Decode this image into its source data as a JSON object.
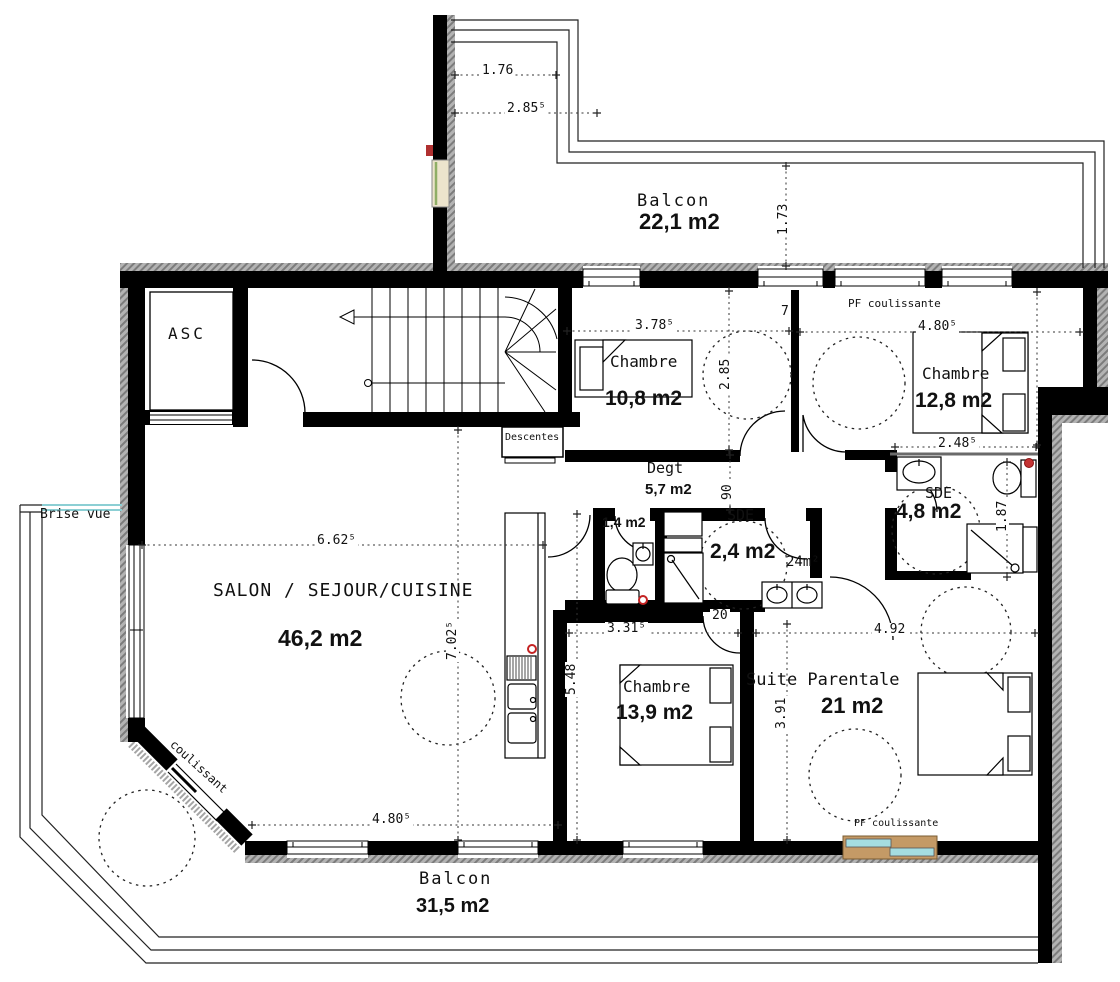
{
  "meta": {
    "title": "Plan d'étage - appartement"
  },
  "colors": {
    "wall": "#000000",
    "hatch": "#a8a8a8",
    "line": "#222222",
    "glass_cyan": "#a5dde0",
    "frame_tan": "#c49a66",
    "glass_green": "#8fae66",
    "accent_red": "#c42222"
  },
  "labels": [
    {
      "name": "asc-room-label",
      "text": "ASC",
      "x": 168,
      "y": 326,
      "cls": "room ls3"
    },
    {
      "name": "balcony-top-label",
      "text": "Balcon",
      "x": 637,
      "y": 193,
      "cls": "room r17 ls2"
    },
    {
      "name": "balcony-top-area",
      "text": "22,1 m2",
      "x": 639,
      "y": 211,
      "cls": "area a22"
    },
    {
      "name": "pf-coulissante-top-label",
      "text": "PF coulissante",
      "x": 848,
      "y": 298,
      "cls": "tiny"
    },
    {
      "name": "bedroom1-label",
      "text": "Chambre",
      "x": 610,
      "y": 354,
      "cls": "room"
    },
    {
      "name": "bedroom1-area",
      "text": "10,8 m2",
      "x": 605,
      "y": 388,
      "cls": "area a21"
    },
    {
      "name": "bedroom2-label",
      "text": "Chambre",
      "x": 922,
      "y": 366,
      "cls": "room"
    },
    {
      "name": "bedroom2-area",
      "text": "12,8 m2",
      "x": 915,
      "y": 390,
      "cls": "area a21"
    },
    {
      "name": "degagement-label",
      "text": "Degt",
      "x": 647,
      "y": 461,
      "cls": "room r15"
    },
    {
      "name": "degagement-area",
      "text": "5,7 m2",
      "x": 645,
      "y": 482,
      "cls": "area a15"
    },
    {
      "name": "wc-area",
      "text": "1,4 m2",
      "x": 602,
      "y": 515,
      "cls": "area a14"
    },
    {
      "name": "sde1-label",
      "text": "SDE",
      "x": 727,
      "y": 508,
      "cls": "room r15"
    },
    {
      "name": "sde1-area",
      "text": "2,4 m2",
      "x": 710,
      "y": 541,
      "cls": "area a21"
    },
    {
      "name": "vanity-note",
      "text": "24m²",
      "x": 786,
      "y": 555,
      "cls": "room r14"
    },
    {
      "name": "sde2-label",
      "text": "SDE",
      "x": 925,
      "y": 486,
      "cls": "room r15"
    },
    {
      "name": "sde2-area",
      "text": "4,8 m2",
      "x": 896,
      "y": 501,
      "cls": "area a21"
    },
    {
      "name": "salon-label",
      "text": "SALON / SEJOUR/CUISINE",
      "x": 213,
      "y": 582,
      "cls": "room r18 ls1"
    },
    {
      "name": "salon-area",
      "text": "46,2 m2",
      "x": 278,
      "y": 627,
      "cls": "area a23"
    },
    {
      "name": "bedroom3-label",
      "text": "Chambre",
      "x": 623,
      "y": 679,
      "cls": "room"
    },
    {
      "name": "bedroom3-area",
      "text": "13,9 m2",
      "x": 616,
      "y": 702,
      "cls": "area a21"
    },
    {
      "name": "suite-label",
      "text": "Suite Parentale",
      "x": 746,
      "y": 672,
      "cls": "room r17"
    },
    {
      "name": "suite-area",
      "text": "21 m2",
      "x": 821,
      "y": 695,
      "cls": "area a22"
    },
    {
      "name": "balcony-bottom-label",
      "text": "Balcon",
      "x": 419,
      "y": 871,
      "cls": "room r17 ls2"
    },
    {
      "name": "balcony-bottom-area",
      "text": "31,5 m2",
      "x": 416,
      "y": 896,
      "cls": "area a20"
    },
    {
      "name": "pf-coulissante-bottom-label",
      "text": "PF coulissante",
      "x": 854,
      "y": 819,
      "cls": "tiny t10"
    },
    {
      "name": "brise-vue-label",
      "text": "Brise vue",
      "x": 40,
      "y": 508,
      "cls": "room r13"
    },
    {
      "name": "coulissant-label",
      "text": "coulissant",
      "x": 176,
      "y": 738,
      "cls": "room r12",
      "rot": 42
    },
    {
      "name": "descentes-label",
      "text": "Descentes",
      "x": 505,
      "y": 433,
      "cls": "tiny t10"
    },
    {
      "name": "wall-dim-7",
      "text": "7",
      "x": 779,
      "y": 305,
      "cls": "dim"
    },
    {
      "name": "wall-dim-20",
      "text": "20",
      "x": 710,
      "y": 609,
      "cls": "dim"
    }
  ],
  "dimensions": [
    {
      "name": "dim-1-76",
      "x1": 455,
      "y1": 75,
      "x2": 556,
      "y2": 75,
      "text": "1.76",
      "lx": 480,
      "ly": 64
    },
    {
      "name": "dim-2-855",
      "x1": 455,
      "y1": 113,
      "x2": 597,
      "y2": 113,
      "text": "2.85⁵",
      "lx": 505,
      "ly": 102
    },
    {
      "name": "dim-1-73",
      "x1": 786,
      "y1": 166,
      "x2": 786,
      "y2": 266,
      "text": "1.73",
      "lx": 777,
      "ly": 237,
      "rot": -90
    },
    {
      "name": "dim-3-785",
      "x1": 567,
      "y1": 331,
      "x2": 789,
      "y2": 331,
      "text": "3.78⁵",
      "lx": 633,
      "ly": 319
    },
    {
      "name": "dim-2-85",
      "x1": 729,
      "y1": 291,
      "x2": 729,
      "y2": 450,
      "text": "2.85",
      "lx": 719,
      "ly": 392,
      "rot": -90
    },
    {
      "name": "dim-4-805-top",
      "x1": 800,
      "y1": 332,
      "x2": 1080,
      "y2": 332,
      "text": "4.80⁵",
      "lx": 916,
      "ly": 320
    },
    {
      "name": "dim-2-485",
      "x1": 895,
      "y1": 447,
      "x2": 1036,
      "y2": 447,
      "text": "2.48⁵",
      "lx": 936,
      "ly": 437
    },
    {
      "name": "dim-1-87",
      "x1": 1007,
      "y1": 462,
      "x2": 1007,
      "y2": 577,
      "text": "1.87",
      "lx": 996,
      "ly": 534,
      "rot": -90
    },
    {
      "name": "dim-90",
      "x1": 730,
      "y1": 455,
      "x2": 730,
      "y2": 510,
      "text": "90",
      "lx": 721,
      "ly": 502,
      "rot": -90
    },
    {
      "name": "dim-6-625",
      "x1": 142,
      "y1": 545,
      "x2": 543,
      "y2": 545,
      "text": "6.62⁵",
      "lx": 315,
      "ly": 534
    },
    {
      "name": "dim-7-025",
      "x1": 458,
      "y1": 430,
      "x2": 458,
      "y2": 840,
      "text": "7.02⁵",
      "lx": 446,
      "ly": 662,
      "rot": -90
    },
    {
      "name": "dim-5-48",
      "x1": 577,
      "y1": 514,
      "x2": 577,
      "y2": 840,
      "text": "5.48",
      "lx": 565,
      "ly": 697,
      "rot": -90
    },
    {
      "name": "dim-3-315",
      "x1": 569,
      "y1": 633,
      "x2": 738,
      "y2": 633,
      "text": "3.31⁵",
      "lx": 605,
      "ly": 622
    },
    {
      "name": "dim-4-92",
      "x1": 756,
      "y1": 633,
      "x2": 1035,
      "y2": 633,
      "text": "4.92",
      "lx": 872,
      "ly": 623
    },
    {
      "name": "dim-3-91",
      "x1": 787,
      "y1": 624,
      "x2": 787,
      "y2": 840,
      "text": "3.91",
      "lx": 775,
      "ly": 731,
      "rot": -90
    },
    {
      "name": "dim-4-805-bottom",
      "x1": 252,
      "y1": 825,
      "x2": 558,
      "y2": 825,
      "text": "4.80⁵",
      "lx": 370,
      "ly": 813
    },
    {
      "name": "dim-chain-right",
      "x1": 1037,
      "y1": 292,
      "x2": 1037,
      "y2": 445,
      "text": "",
      "lx": 0,
      "ly": 0
    }
  ]
}
